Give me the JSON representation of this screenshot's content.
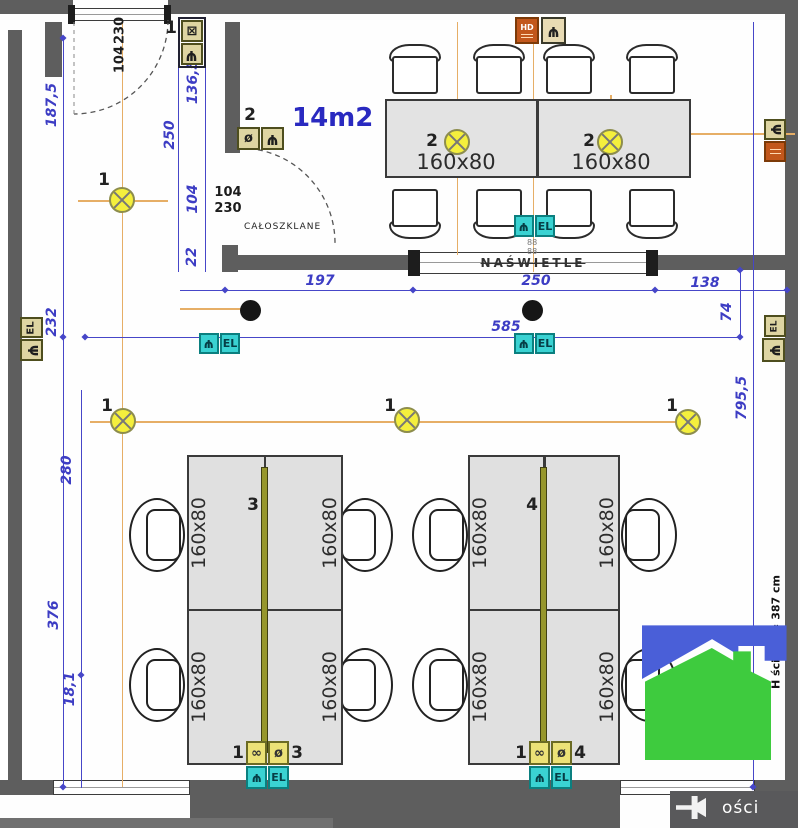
{
  "texts": {
    "area_label": "14m2",
    "glass_door_note": "CAŁOSZKLANE",
    "transom_label": "NAŚWIETLE",
    "wall_height_note": "H ściany = 387 cm",
    "watermark_fragment": "ości",
    "desk_size": "160x80",
    "door_width": "104",
    "door_height": "230",
    "el_label": "EL",
    "hd_label": "HD",
    "small_dim": "88"
  },
  "dims": {
    "left_wall": [
      "187,5",
      "232",
      "280",
      "376",
      "18,1"
    ],
    "entry_chain": [
      "136,5",
      "250",
      "104",
      "22"
    ],
    "ceiling_spans": [
      "197",
      "250",
      "138"
    ],
    "ceiling_total": "585",
    "wall_offset": "74",
    "total_height": "795,5"
  },
  "markers": {
    "group1": "1",
    "group2": "2",
    "group3": "3",
    "group4": "4"
  },
  "icons": {
    "socket_glyph": "Ψ",
    "switch_glyph": "ø",
    "double_socket_glyph": "∞",
    "crossed_box_glyph": "⊠"
  },
  "colors": {
    "wall": "#5e5e5e",
    "dimension_blue": "#3d3dc4",
    "construction_orange": "#e6ae66",
    "light_yellow": "#f4ef3d",
    "socket_teal": "#3ad2d2",
    "logo_blue": "#4a5fd8",
    "logo_green": "#3ecb3e"
  }
}
